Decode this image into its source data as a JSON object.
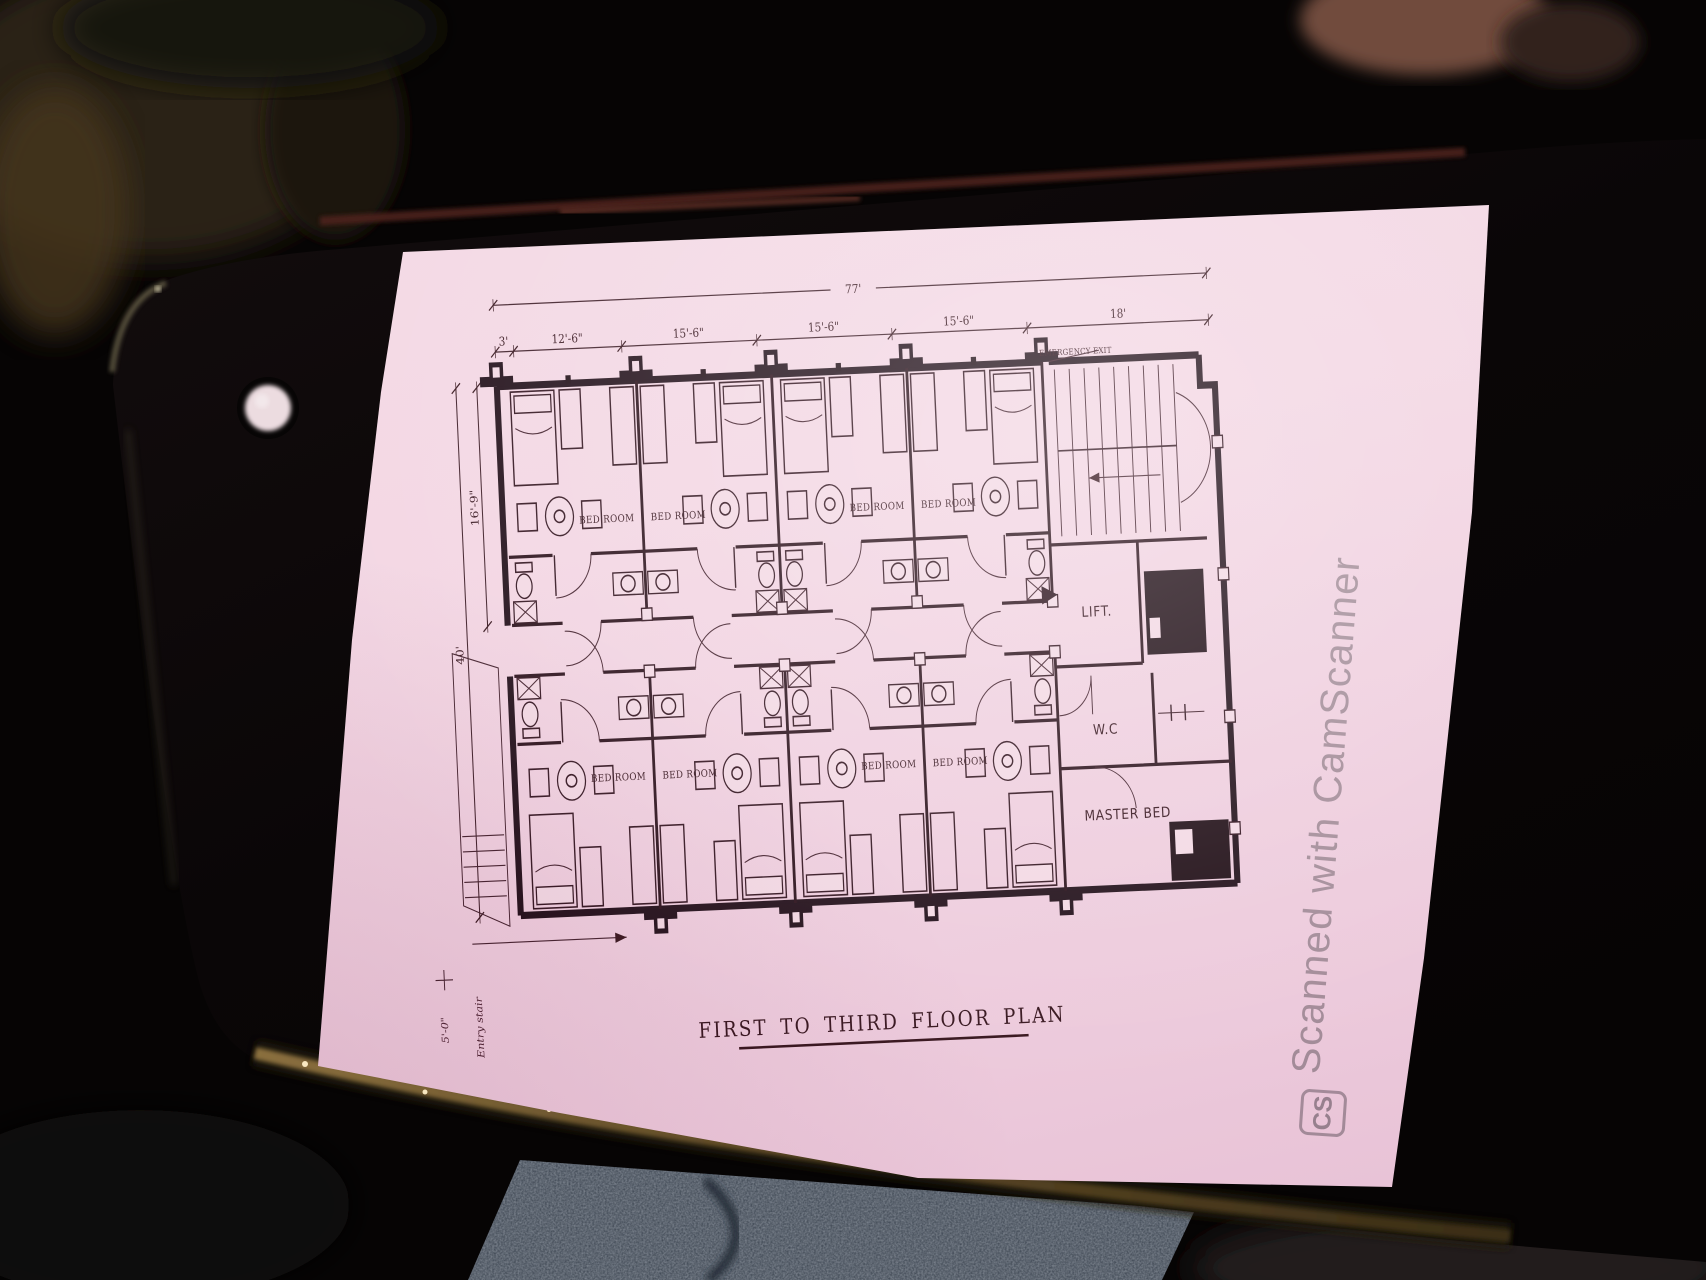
{
  "watermark": {
    "logo_text": "CS",
    "text": "Scanned with CamScanner"
  },
  "floor_plan": {
    "title": "FIRST TO THIRD FLOOR PLAN",
    "dimensions": {
      "overall_width": "77'",
      "width_segments": [
        "3'",
        "12'-6\"",
        "15'-6\"",
        "15'-6\"",
        "15'-6\"",
        "18'"
      ],
      "room_depth": "16'-9\"",
      "overall_depth": "40'"
    },
    "rooms": {
      "emergency_exit": "EMERGENCY EXIT",
      "lift": "LIFT.",
      "wc": "W.C",
      "master_bed": "MASTER BED",
      "bedrooms_upper": [
        "BED ROOM",
        "BED ROOM",
        "BED ROOM",
        "BED ROOM"
      ],
      "bedrooms_lower": [
        "BED ROOM",
        "BED ROOM",
        "BED ROOM",
        "BED ROOM"
      ]
    },
    "notes": [
      "5'-0\"",
      "Entry stair"
    ]
  }
}
